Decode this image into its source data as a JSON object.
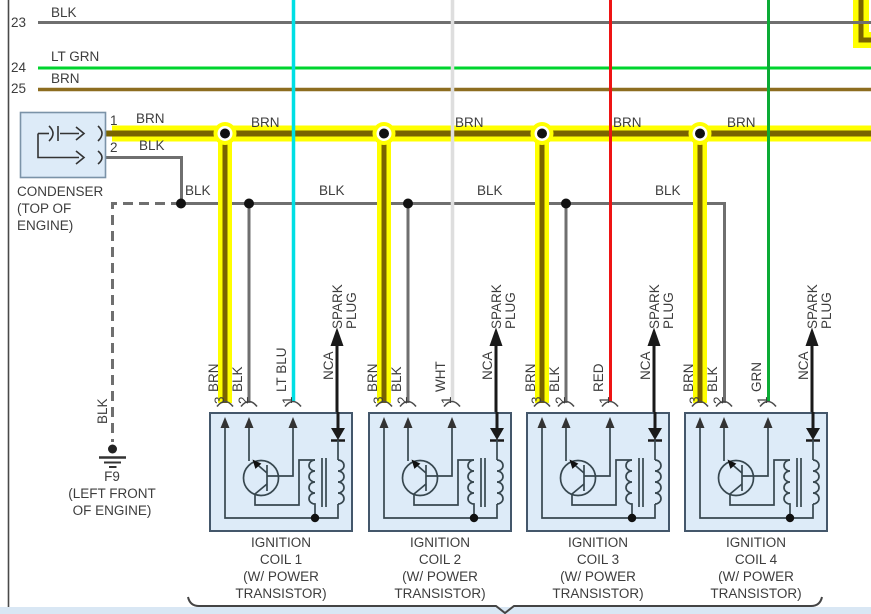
{
  "colors": {
    "blk": "#6f6f6f",
    "lt_grn": "#00d42e",
    "brn": "#8d6d20",
    "brn_core": "#7a6400",
    "yellow": "#ffff00",
    "lt_blu": "#00dfe4",
    "wht": "#dedede",
    "red": "#ee1414",
    "grn": "#0bab35",
    "box_fill": "#ddebf8",
    "box_border": "#44576b",
    "circuit": "#37474f",
    "dark": "#333333",
    "strip": "#d9e7f4",
    "cond_border": "#7b93a8",
    "ink": "#3d3d3d"
  },
  "top_wires": [
    {
      "num": "23",
      "label": "BLK"
    },
    {
      "num": "24",
      "label": "LT GRN"
    },
    {
      "num": "25",
      "label": "BRN"
    }
  ],
  "bus": {
    "labels": [
      "BRN",
      "BRN",
      "BRN",
      "BRN"
    ]
  },
  "blk_line": {
    "labels": [
      "BLK",
      "BLK",
      "BLK",
      "BLK"
    ]
  },
  "condenser": {
    "name": "CONDENSER",
    "location_1": "(TOP OF",
    "location_2": "ENGINE)",
    "pin1": "1",
    "pin2": "2",
    "pin1_wire": "BRN",
    "pin2_wire": "BLK"
  },
  "ground": {
    "wire": "BLK",
    "id": "F9",
    "location_1": "(LEFT FRONT",
    "location_2": "OF ENGINE)"
  },
  "coils": [
    {
      "pin3": "3",
      "pin2": "2",
      "pin1": "1",
      "wire3": "BRN",
      "wire2": "BLK",
      "wire1": "LT BLU",
      "nca": "NCA",
      "spark_1": "SPARK",
      "spark_2": "PLUG",
      "label_1": "IGNITION",
      "label_2": "COIL 1",
      "label_3": "(W/ POWER",
      "label_4": "TRANSISTOR)"
    },
    {
      "pin3": "3",
      "pin2": "2",
      "pin1": "1",
      "wire3": "BRN",
      "wire2": "BLK",
      "wire1": "WHT",
      "nca": "NCA",
      "spark_1": "SPARK",
      "spark_2": "PLUG",
      "label_1": "IGNITION",
      "label_2": "COIL 2",
      "label_3": "(W/ POWER",
      "label_4": "TRANSISTOR)"
    },
    {
      "pin3": "3",
      "pin2": "2",
      "pin1": "1",
      "wire3": "BRN",
      "wire2": "BLK",
      "wire1": "RED",
      "nca": "NCA",
      "spark_1": "SPARK",
      "spark_2": "PLUG",
      "label_1": "IGNITION",
      "label_2": "COIL 3",
      "label_3": "(W/ POWER",
      "label_4": "TRANSISTOR)"
    },
    {
      "pin3": "3",
      "pin2": "2",
      "pin1": "1",
      "wire3": "BRN",
      "wire2": "BLK",
      "wire1": "GRN",
      "nca": "NCA",
      "spark_1": "SPARK",
      "spark_2": "PLUG",
      "label_1": "IGNITION",
      "label_2": "COIL 4",
      "label_3": "(W/ POWER",
      "label_4": "TRANSISTOR)"
    }
  ]
}
